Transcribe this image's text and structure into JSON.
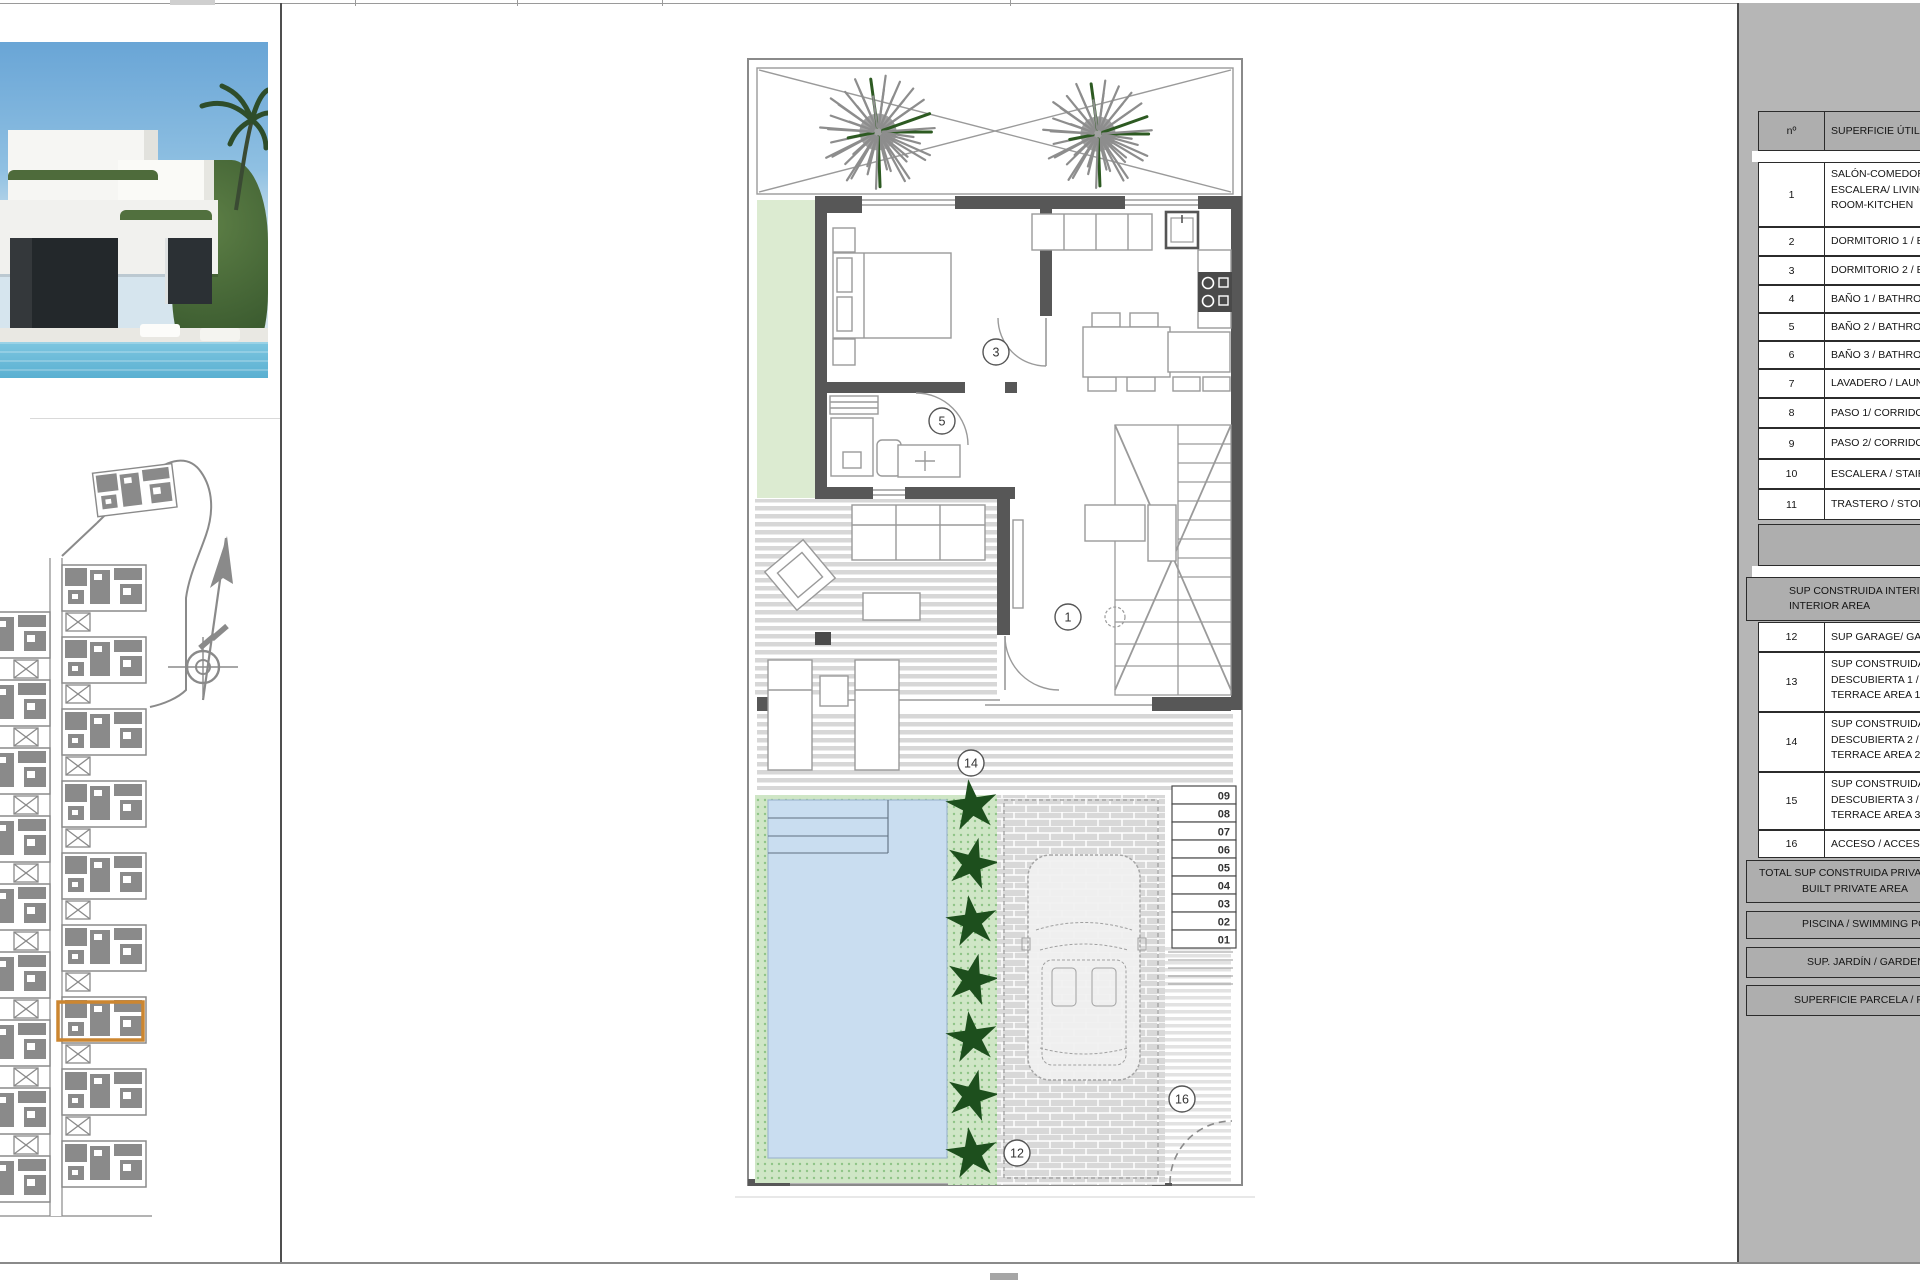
{
  "colors": {
    "highlight": "#cc8630",
    "panel_gray": "#b6b6b6",
    "wall": "#575757",
    "pool_water": "#c9ddf0",
    "garden_green": "#dcebd1",
    "hedge_dark": "#1d4f1d",
    "site_gray": "#8a8a8a"
  },
  "floor_plan": {
    "room_labels": [
      {
        "n": "3",
        "x": 996,
        "y": 352
      },
      {
        "n": "5",
        "x": 942,
        "y": 421
      },
      {
        "n": "1",
        "x": 1068,
        "y": 617
      },
      {
        "n": "14",
        "x": 971,
        "y": 763
      },
      {
        "n": "12",
        "x": 1017,
        "y": 1153
      },
      {
        "n": "16",
        "x": 1182,
        "y": 1099
      }
    ],
    "stair_steps": [
      "09",
      "08",
      "07",
      "06",
      "05",
      "04",
      "03",
      "02",
      "01"
    ]
  },
  "area_table": {
    "header": {
      "num": "nº",
      "label": "SUPERFICIE ÚTIL"
    },
    "layout": [
      {
        "kind": "head",
        "y": 111,
        "h": 40,
        "num": "nº",
        "lines": [
          "SUPERFICIE ÚTIL"
        ]
      },
      {
        "kind": "gap",
        "y": 151,
        "h": 11
      },
      {
        "kind": "row",
        "y": 162,
        "h": 65,
        "num": "1",
        "lines": [
          "SALÓN-COMEDOR-",
          "ESCALERA/ LIVING",
          "ROOM-KITCHEN"
        ]
      },
      {
        "kind": "row",
        "y": 227,
        "h": 29,
        "num": "2",
        "lines": [
          "DORMITORIO 1 / BEDROOM 1"
        ]
      },
      {
        "kind": "row",
        "y": 256,
        "h": 29,
        "num": "3",
        "lines": [
          "DORMITORIO 2 / BEDROOM 2"
        ]
      },
      {
        "kind": "row",
        "y": 285,
        "h": 28,
        "num": "4",
        "lines": [
          "BAÑO 1 / BATHROOM 1"
        ]
      },
      {
        "kind": "row",
        "y": 313,
        "h": 28,
        "num": "5",
        "lines": [
          "BAÑO 2 / BATHROOM 2"
        ]
      },
      {
        "kind": "row",
        "y": 341,
        "h": 28,
        "num": "6",
        "lines": [
          "BAÑO 3 / BATHROOM 3"
        ]
      },
      {
        "kind": "row",
        "y": 369,
        "h": 29,
        "num": "7",
        "lines": [
          "LAVADERO / LAUNDRY"
        ]
      },
      {
        "kind": "row",
        "y": 398,
        "h": 30,
        "num": "8",
        "lines": [
          "PASO 1/ CORRIDOR 1"
        ]
      },
      {
        "kind": "row",
        "y": 428,
        "h": 31,
        "num": "9",
        "lines": [
          "PASO 2/ CORRIDOR 2"
        ]
      },
      {
        "kind": "row",
        "y": 459,
        "h": 30,
        "num": "10",
        "lines": [
          "ESCALERA / STAIRS"
        ]
      },
      {
        "kind": "row",
        "y": 489,
        "h": 31,
        "num": "11",
        "lines": [
          "TRASTERO / STORAGE"
        ]
      },
      {
        "kind": "block",
        "y": 524,
        "h": 42
      },
      {
        "kind": "gap",
        "y": 566,
        "h": 11
      },
      {
        "kind": "bar",
        "y": 577,
        "h": 44,
        "lines": [
          "SUP CONSTRUIDA INTERIOR / BUILT",
          "INTERIOR AREA"
        ],
        "pads": [
          42,
          42
        ]
      },
      {
        "kind": "row",
        "y": 622,
        "h": 30,
        "num": "12",
        "lines": [
          "SUP GARAGE/ GARAGE"
        ]
      },
      {
        "kind": "row",
        "y": 652,
        "h": 60,
        "num": "13",
        "lines": [
          "SUP CONSTRUIDA",
          "DESCUBIERTA 1 /",
          "TERRACE AREA 1"
        ]
      },
      {
        "kind": "row",
        "y": 712,
        "h": 60,
        "num": "14",
        "lines": [
          "SUP CONSTRUIDA",
          "DESCUBIERTA 2 /",
          "TERRACE AREA 2"
        ]
      },
      {
        "kind": "row",
        "y": 772,
        "h": 58,
        "num": "15",
        "lines": [
          "SUP CONSTRUIDA",
          "DESCUBIERTA 3 /",
          "TERRACE AREA 3"
        ]
      },
      {
        "kind": "row",
        "y": 830,
        "h": 28,
        "num": "16",
        "lines": [
          "ACCESO / ACCESS"
        ]
      },
      {
        "kind": "bar",
        "y": 860,
        "h": 43,
        "lines": [
          "TOTAL SUP CONSTRUIDA PRIVADA / TOTAL",
          "BUILT PRIVATE AREA"
        ],
        "pads": [
          12,
          55
        ]
      },
      {
        "kind": "bar",
        "y": 911,
        "h": 28,
        "lines": [
          "PISCINA / SWIMMING POOL"
        ],
        "pads": [
          55
        ]
      },
      {
        "kind": "bar",
        "y": 947,
        "h": 31,
        "lines": [
          "SUP. JARDÍN / GARDEN AREA"
        ],
        "pads": [
          60
        ]
      },
      {
        "kind": "bar",
        "y": 985,
        "h": 31,
        "lines": [
          "SUPERFICIE PARCELA / PLOT AREA"
        ],
        "pads": [
          47
        ]
      }
    ]
  }
}
